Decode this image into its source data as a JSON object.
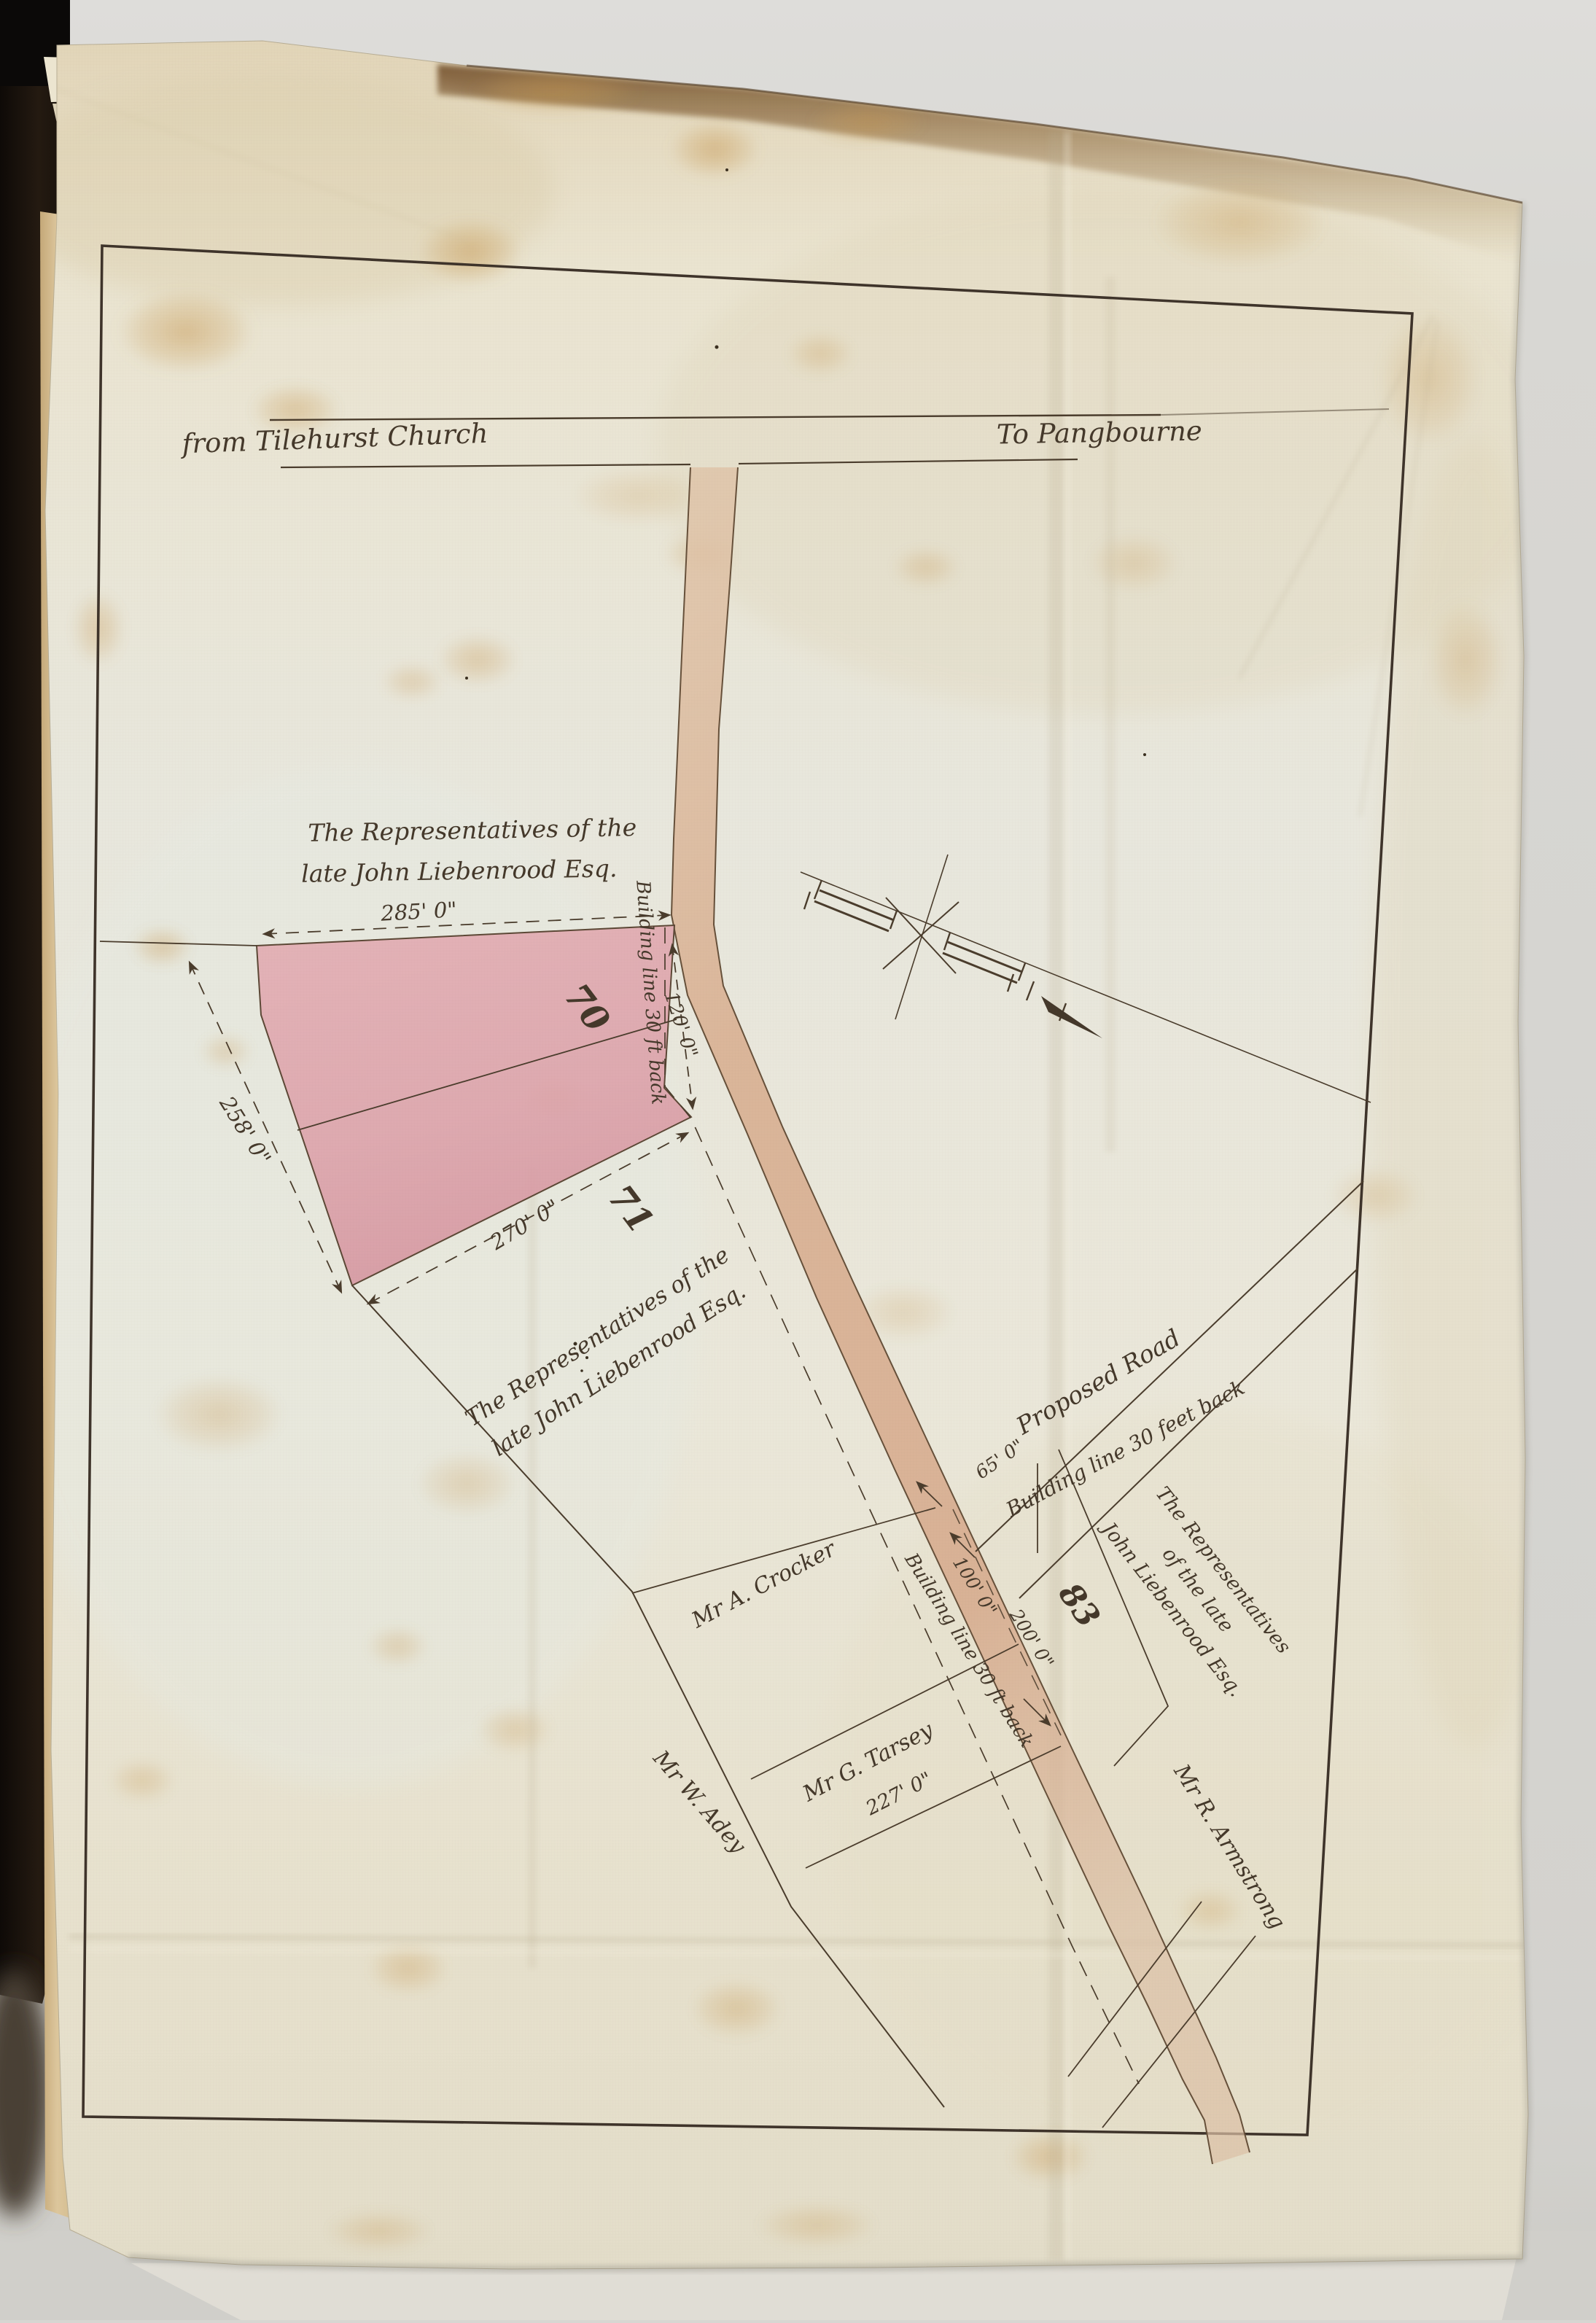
{
  "map": {
    "roads": {
      "from_label": "from Tilehurst Church",
      "to_label": "To Pangbourne",
      "proposed_road_label": "Proposed Road"
    },
    "owners": {
      "north_block": {
        "line1": "The Representatives of the",
        "line2": "late John Liebenrood Esq."
      },
      "mid_block": {
        "line1": "The Representatives of the",
        "line2": "late John Liebenrood Esq."
      },
      "east_block": {
        "line1": "The Representatives",
        "line2": "of the late",
        "line3": "John Liebenrood Esq."
      },
      "crocker": "Mr A. Crocker",
      "tarsey": "Mr G. Tarsey",
      "adey": "Mr W. Adey",
      "armstrong": "Mr R. Armstrong"
    },
    "plots": {
      "plot_70": "70",
      "plot_71": "71",
      "plot_83": "83"
    },
    "dimensions": {
      "top_frontage": "285' 0\"",
      "west_side": "258' 0\"",
      "south_side": "270' 0\"",
      "road_bend": "120' 0\"",
      "proposed_road_width": "65' 0\"",
      "frontage_100": "100' 0\"",
      "frontage_200": "200' 0\"",
      "tarsey_frontage": "227' 0\""
    },
    "building_lines": {
      "west_vertical": "Building line 30 ft back",
      "west_diagonal": "Building line 30 ft back",
      "northeast": "Building line 30 feet back"
    },
    "colors": {
      "plot_pink": "#dfa5ab",
      "road_tint": "#d9ae92",
      "ink": "#44382a",
      "paper": "#e9e4d2",
      "border": "#3e332a"
    }
  }
}
